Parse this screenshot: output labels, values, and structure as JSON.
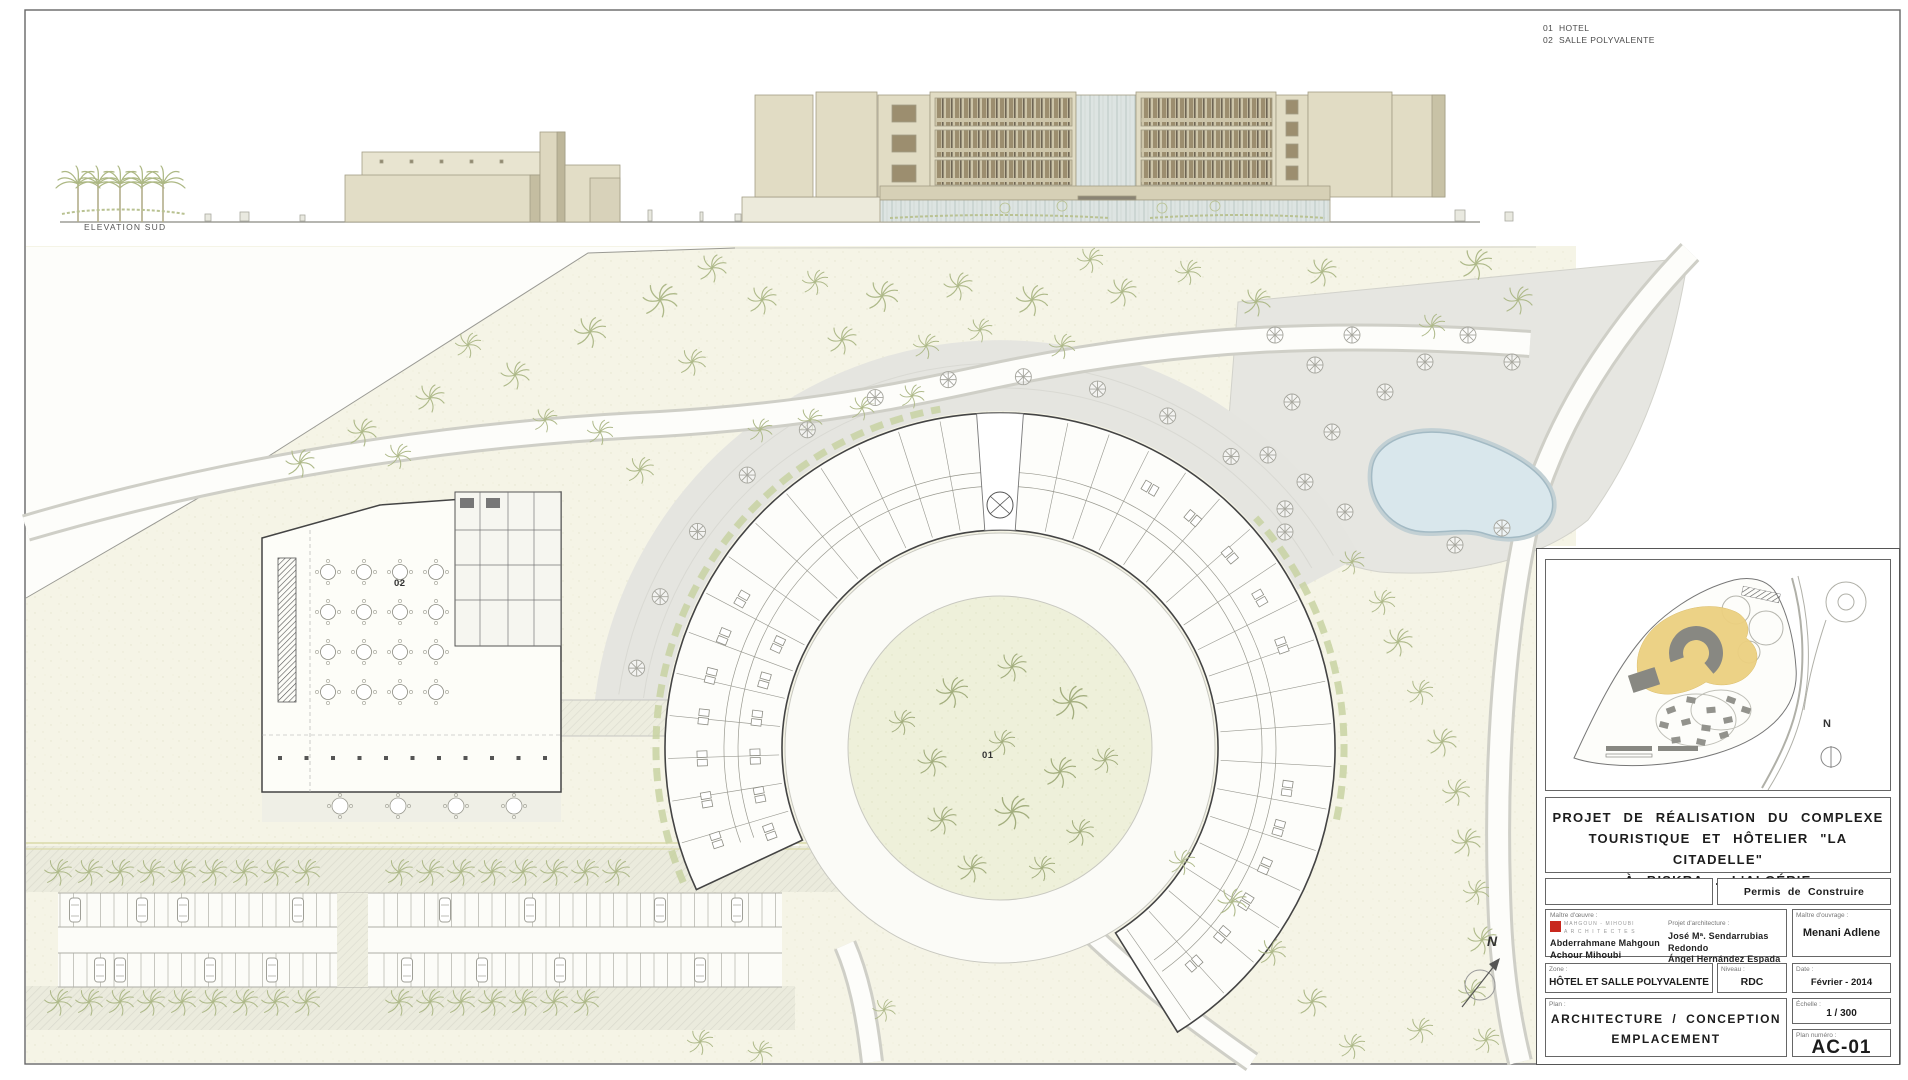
{
  "legend": {
    "items": [
      {
        "num": "01",
        "label": "HOTEL"
      },
      {
        "num": "02",
        "label": "SALLE POLYVALENTE"
      }
    ]
  },
  "elevation": {
    "label": "ELEVATION SUD"
  },
  "plan": {
    "hotel_label": "01",
    "salle_label": "02",
    "north_letter": "N"
  },
  "title_block": {
    "project_title_line1": "PROJET DE RÉALISATION DU COMPLEXE",
    "project_title_line2": "TOURISTIQUE ET HÔTELIER \"LA CITADELLE\"",
    "project_title_line3": "À BISKRA . L'ALGÉRIE",
    "permit": "Permis de Construire",
    "maitre_oeuvre_label": "Maître d'œuvre :",
    "logo_line1": "MAHGOUN - MIHOUBI",
    "logo_line2": "A R C H I T E C T E S",
    "oeuvre_name1": "Abderrahmane Mahgoun",
    "oeuvre_name2": "Achour Mihoubi",
    "architecture_label": "Projet d'architecture :",
    "arch_name1": "José Mª. Sendarrubias Redondo",
    "arch_name2": "Ángel Hernández Espada",
    "maitre_ouvrage_label": "Maître d'ouvrage :",
    "ouvrage_name": "Menani Adlene",
    "zone_label": "Zone :",
    "zone_value": "HÔTEL ET SALLE POLYVALENTE",
    "niveau_label": "Niveau :",
    "niveau_value": "RDC",
    "date_label": "Date :",
    "date_value": "Février - 2014",
    "plan_label": "Plan :",
    "plan_value_line1": "ARCHITECTURE / CONCEPTION",
    "plan_value_line2": "EMPLACEMENT",
    "echelle_label": "Échelle :",
    "echelle_value": "1 / 300",
    "plan_num_label": "Plan numéro :",
    "plan_num_value": "AC-01",
    "keyplan_north_letter": "N"
  },
  "colors": {
    "logo_red": "#c8281e",
    "highlight_yellow": "#ecd080",
    "pool_blue": "#d9e7ec",
    "sand": "#f5f4e6",
    "palm_green": "#aeb989"
  }
}
